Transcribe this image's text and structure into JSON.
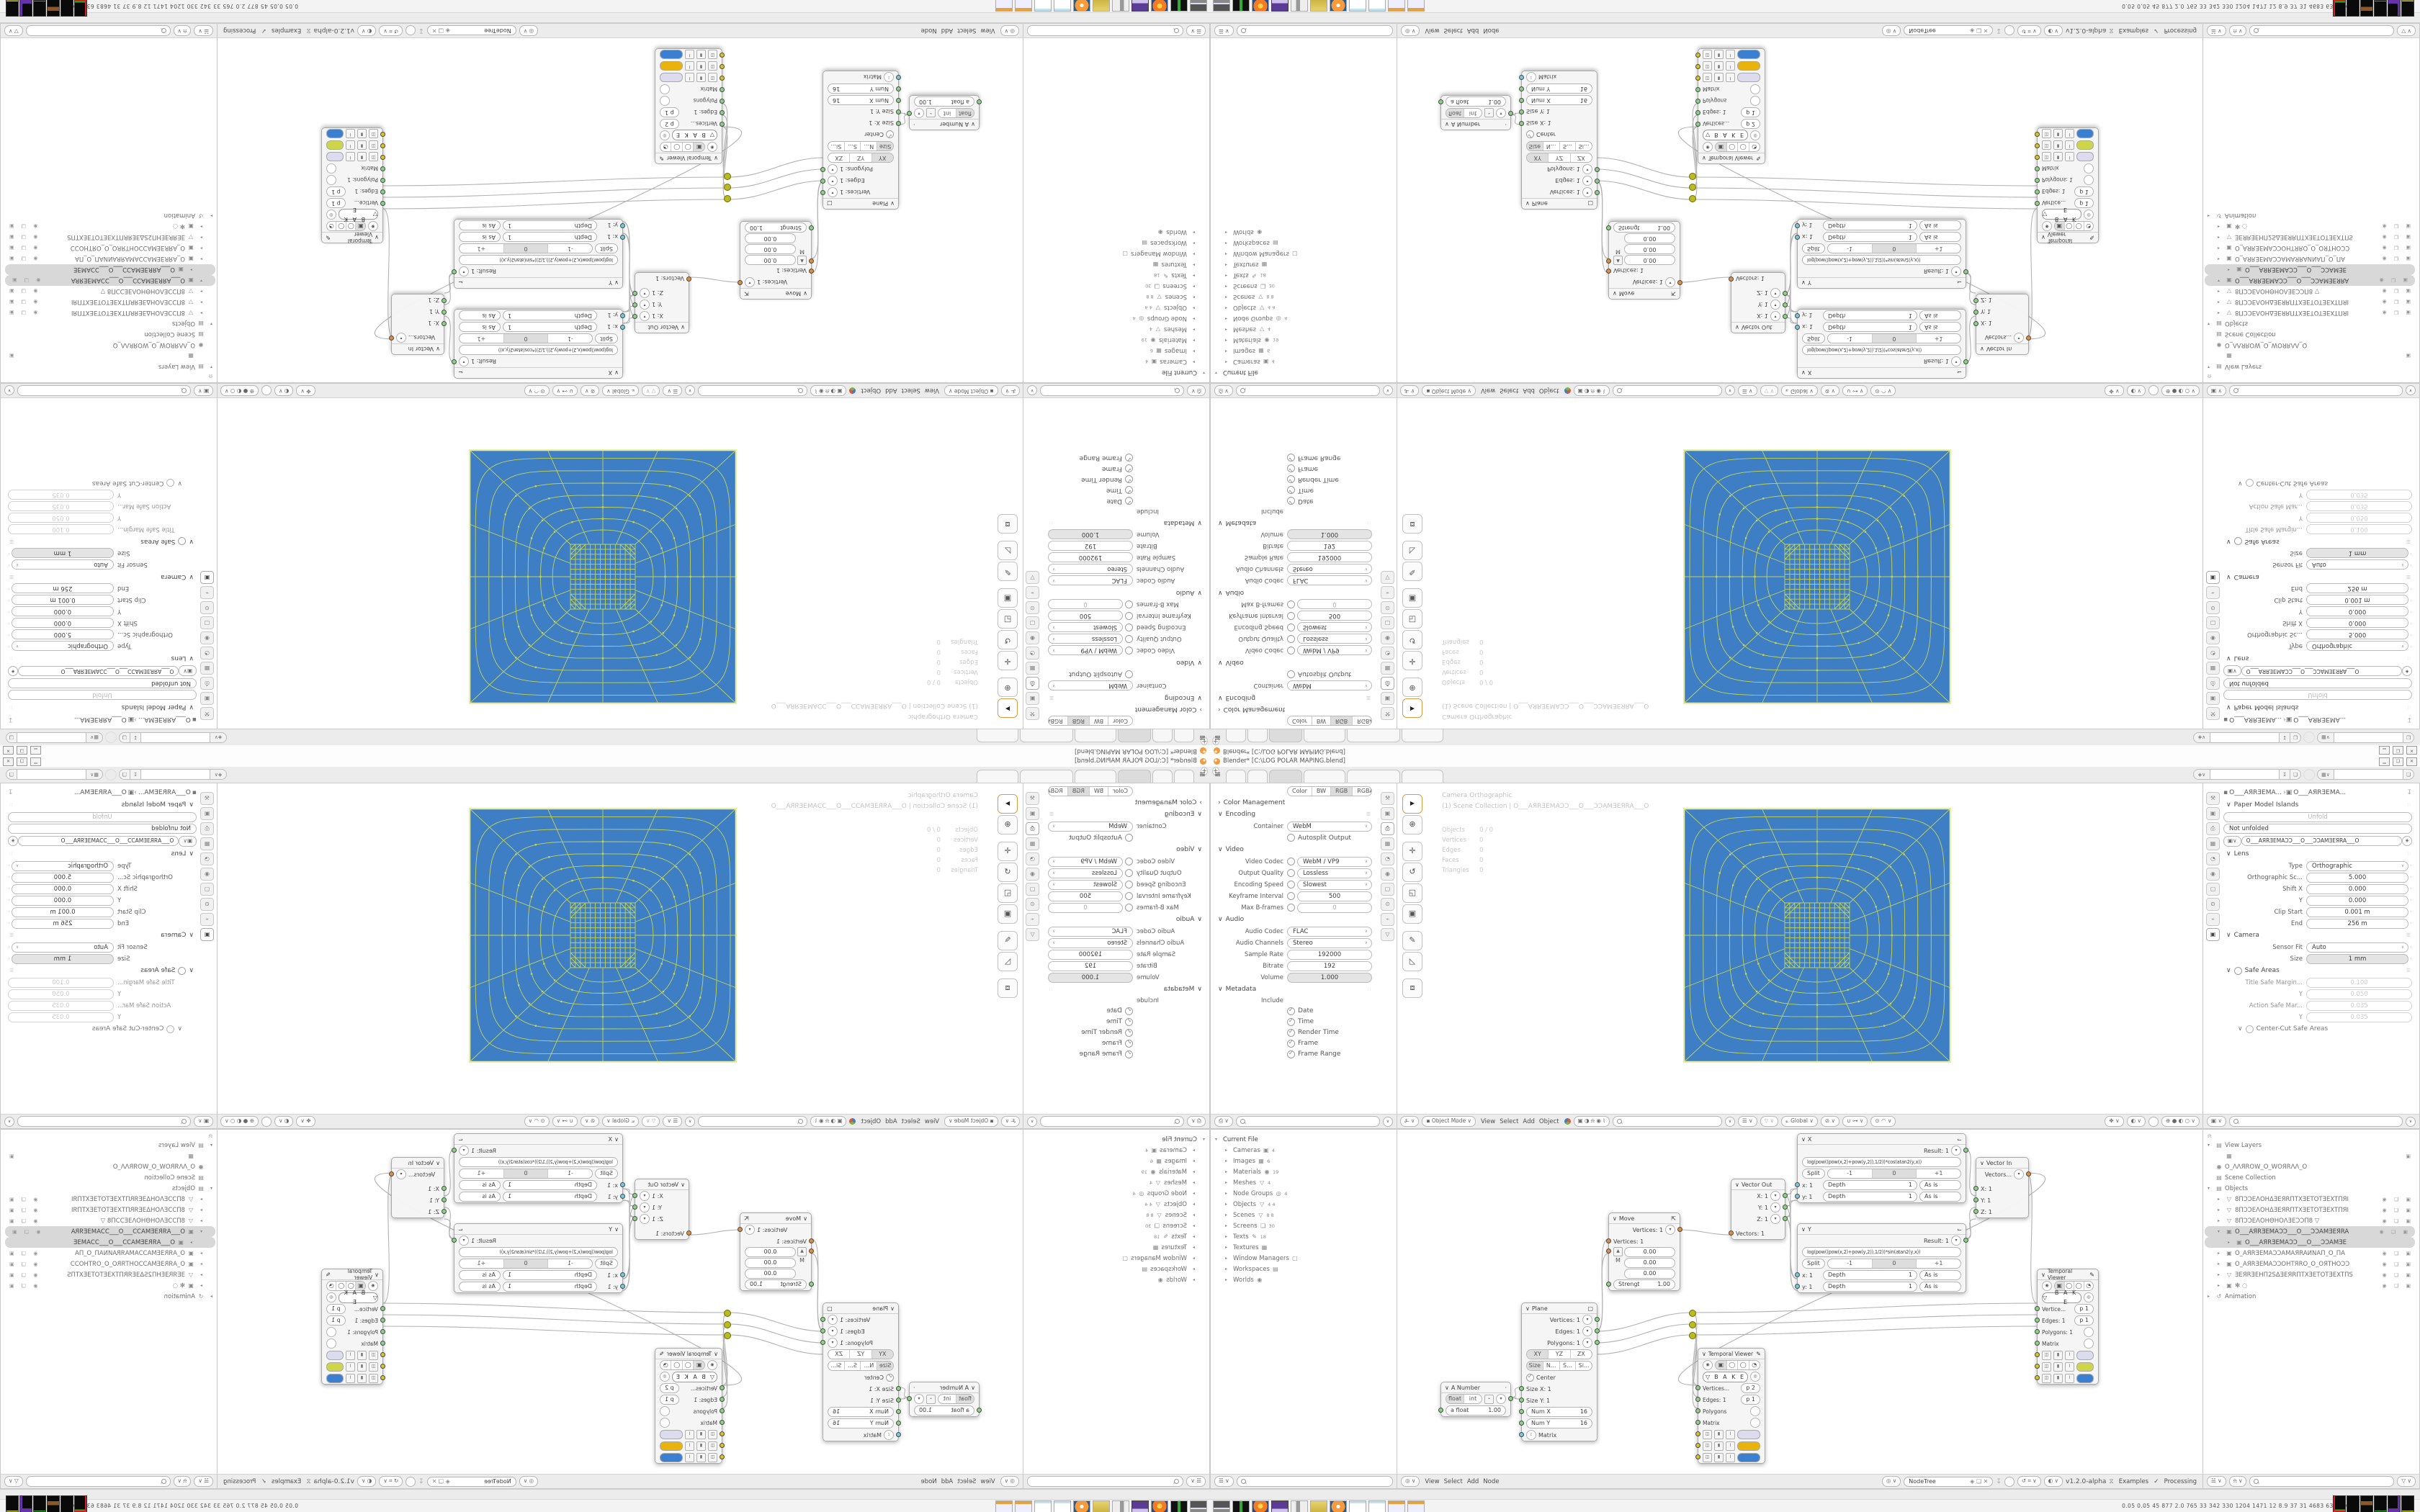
{
  "window": {
    "title": "Blender* [C:\\LOG POLAR MAPING.blend]",
    "minimize": "▁",
    "maximize": "❏",
    "close": "✕"
  },
  "icons": {
    "menu": "≡",
    "plus": "+",
    "collapse": "∨",
    "expand": "›",
    "tri_down": "▾",
    "tri_right": "▸",
    "dropdown": "∨",
    "check": "✓",
    "pin": "↧",
    "copy": "❏",
    "close_x": "✕",
    "shield": "◈",
    "dots": "∷",
    "preset": "☰",
    "flag": "⌙",
    "pencil": "✎",
    "eye": "◉",
    "bake_tri": "▽",
    "select_arrow": "▶",
    "cursor": "⊕",
    "move": "✛",
    "rotate": "↺",
    "scale": "◱",
    "transform": "▣",
    "annotate": "✎",
    "measure": "◺",
    "addcube": "⧈",
    "camera": "▣",
    "sphere_wire": "⊕",
    "sphere_solid": "●",
    "sphere_mat": "◐",
    "sphere_rend": "○",
    "magnet": "∪",
    "prop_edit": "◎",
    "gizmo": "⊙",
    "overlay": "◐",
    "up_arrow": "▲",
    "matrix": "᎒"
  },
  "tabbar": {
    "tab_widths": [
      26,
      26,
      44,
      56,
      72,
      56
    ]
  },
  "taskbar": {
    "numbers": "0.05 0.05  45  877  2.0  765  33  342  330  1204 1471  12  8.9  37  31  4683 6354",
    "chevron": "«",
    "icons": [
      {
        "name": "monitor",
        "cls": "tbi i-monitor"
      },
      {
        "name": "device",
        "cls": "tbi i-device"
      },
      {
        "name": "firefox",
        "cls": "tbi i-firefox"
      },
      {
        "name": "floppy-64",
        "cls": "tbi i-floppy"
      },
      {
        "name": "speaker",
        "cls": "tbi i-speaker"
      },
      {
        "name": "folder",
        "cls": "tbi i-folder"
      },
      {
        "name": "blender",
        "cls": "tbi i-blender"
      },
      {
        "name": "notepad",
        "cls": "tbi i-notepad"
      },
      {
        "name": "notepad",
        "cls": "tbi i-notepad"
      },
      {
        "name": "calculator",
        "cls": "tbi i-calc"
      },
      {
        "name": "calculator",
        "cls": "tbi i-calc"
      }
    ],
    "blocks": [
      {
        "cls": "blk b1"
      },
      {
        "cls": "blk b2"
      },
      {
        "cls": "blk b3"
      },
      {
        "cls": "blk b4"
      },
      {
        "cls": "blk b5"
      },
      {
        "cls": "blk b6"
      }
    ]
  },
  "output_props": {
    "color_modes": [
      {
        "label": "Color",
        "cls": ""
      },
      {
        "label": "BW",
        "cls": ""
      },
      {
        "label": "RGB",
        "cls": "on"
      },
      {
        "label": "RGBA",
        "cls": ""
      }
    ],
    "color_management": "Color Management",
    "encoding": "Encoding",
    "container_label": "Container",
    "container": "WebM",
    "autosplit": "Autosplit Output",
    "video": "Video",
    "video_rows": [
      {
        "label": "Video Codec",
        "value": "WebM / VP9",
        "vcls": "pv sel",
        "ck": "0"
      },
      {
        "label": "Output Quality",
        "value": "Lossless",
        "vcls": "pv sel",
        "ck": "0"
      },
      {
        "label": "Encoding Speed",
        "value": "Slowest",
        "vcls": "pv sel",
        "ck": "0"
      },
      {
        "label": "Keyframe Interval",
        "value": "500",
        "vcls": "pv",
        "ck": "0"
      },
      {
        "label": "Max B-frames",
        "value": "0",
        "vcls": "pv dis",
        "ck": "1"
      }
    ],
    "audio": "Audio",
    "audio_rows": [
      {
        "label": "Audio Codec",
        "value": "FLAC",
        "vcls": "pv sel",
        "ck": "0"
      },
      {
        "label": "Audio Channels",
        "value": "Stereo",
        "vcls": "pv sel",
        "ck": "0"
      },
      {
        "label": "Sample Rate",
        "value": "192000",
        "vcls": "pv",
        "ck": "0"
      },
      {
        "label": "Bitrate",
        "value": "192",
        "vcls": "pv",
        "ck": "0"
      },
      {
        "label": "Volume",
        "value": "1.000",
        "vcls": "pv slider",
        "ck": "0"
      }
    ],
    "metadata": "Metadata",
    "include_label": "Include",
    "metadata_items": [
      "Date",
      "Time",
      "Render Time",
      "Frame",
      "Frame Range"
    ]
  },
  "file_outliner": {
    "root": "Current File",
    "items": [
      {
        "label": "Cameras",
        "ic": "▣",
        "count": "4"
      },
      {
        "label": "Images",
        "ic": "▦",
        "count": "6"
      },
      {
        "label": "Materials",
        "ic": "◉",
        "count": "19"
      },
      {
        "label": "Meshes",
        "ic": "▽",
        "count": "4"
      },
      {
        "label": "Node Groups",
        "ic": "◎",
        "count": "4"
      },
      {
        "label": "Objects",
        "ic": "▽",
        "count": "4 4"
      },
      {
        "label": "Scenes",
        "ic": "▽",
        "count": "8 8"
      },
      {
        "label": "Screens",
        "ic": "❏",
        "count": "30"
      },
      {
        "label": "Texts",
        "ic": "✎",
        "count": "18"
      },
      {
        "label": "Textures",
        "ic": "▦",
        "count": ""
      },
      {
        "label": "Window Managers",
        "ic": "▢",
        "count": ""
      },
      {
        "label": "Workspaces",
        "ic": "▤",
        "count": ""
      },
      {
        "label": "Worlds",
        "ic": "◉",
        "count": ""
      }
    ]
  },
  "viewport": {
    "overlay_title": "Camera Orthographic",
    "overlay_breadcrumb": "(1) Scene Collection | O___AЯRƎEMAƆƆ___O___ƆƆAMƎEЯRA___O",
    "stats": [
      {
        "k": "Objects",
        "v": "0 / 0"
      },
      {
        "k": "Vertices",
        "v": "0"
      },
      {
        "k": "Edges",
        "v": "0"
      },
      {
        "k": "Faces",
        "v": "0"
      },
      {
        "k": "Triangles",
        "v": "0"
      }
    ],
    "mode": "Object Mode",
    "menus": [
      "View",
      "Select",
      "Add",
      "Object"
    ],
    "orientation": "Global"
  },
  "camera_props": {
    "breadcrumb_a": "O___AЯRƎEMA...",
    "breadcrumb_b": "O___AЯRƎEMA...",
    "paper_title": "Paper Model Islands",
    "unfold": "Unfold",
    "unfold_status": "Not unfolded",
    "id_name": "O___AЯRƎEMAƆƆ___O___ƆƆAMƎEЯRA___O",
    "lens": "Lens",
    "lens_rows": [
      {
        "label": "Type",
        "value": "Orthographic",
        "vcls": "pv sel"
      },
      {
        "label": "Orthographic Sc...",
        "value": "5.000",
        "vcls": "pv"
      },
      {
        "label": "Shift X",
        "value": "0.000",
        "vcls": "pv"
      },
      {
        "label": "Y",
        "value": "0.000",
        "vcls": "pv"
      },
      {
        "label": "Clip Start",
        "value": "0.001 m",
        "vcls": "pv"
      },
      {
        "label": "End",
        "value": "256 m",
        "vcls": "pv"
      }
    ],
    "camera": "Camera",
    "camera_rows": [
      {
        "label": "Sensor Fit",
        "value": "Auto",
        "vcls": "pv sel"
      },
      {
        "label": "Size",
        "value": "1 mm",
        "vcls": "pv slider"
      }
    ],
    "safe": "Safe Areas",
    "safe_rows": [
      {
        "label": "Title Safe Margin...",
        "value": "0.100",
        "vcls": "pv dis"
      },
      {
        "label": "Y",
        "value": "0.050",
        "vcls": "pv dis"
      },
      {
        "label": "Action Safe Mar...",
        "value": "0.035",
        "vcls": "pv dis"
      },
      {
        "label": "Y",
        "value": "0.035",
        "vcls": "pv dis"
      }
    ],
    "centercut": "Center-Cut Safe Areas"
  },
  "node_editor": {
    "menus": [
      "View",
      "Select",
      "Add",
      "Node"
    ],
    "tree": "NodeTree",
    "version": "v1.2.0-alpha",
    "examples": "Examples",
    "processing": "Processing",
    "x_node": {
      "title": "X",
      "result": "Result: 1",
      "formula": "log(pow((pow(x,2)+pow(y,2)),1/2))*cos(atan2(y,x))",
      "split": "Split",
      "seg": [
        {
          "label": "-1",
          "cls": ""
        },
        {
          "label": "0",
          "cls": "on"
        },
        {
          "label": "+1",
          "cls": ""
        }
      ],
      "rows": [
        {
          "s": "x: 1",
          "d": "Depth",
          "n": "1",
          "m": "As is"
        },
        {
          "s": "y: 1",
          "d": "Depth",
          "n": "1",
          "m": "As is"
        }
      ]
    },
    "y_node": {
      "title": "Y",
      "result": "Result: 1",
      "formula": "log(pow((pow(x,2)+pow(y,2)),1/2))*sin(atan2(y,x))",
      "split": "Split",
      "seg": [
        {
          "label": "-1",
          "cls": ""
        },
        {
          "label": "0",
          "cls": "on"
        },
        {
          "label": "+1",
          "cls": ""
        }
      ],
      "rows": [
        {
          "s": "x: 1",
          "d": "Depth",
          "n": "1",
          "m": "As is"
        },
        {
          "s": "y: 1",
          "d": "Depth",
          "n": "1",
          "m": "As is"
        }
      ]
    },
    "vector_in": {
      "title": "Vector In",
      "out": "Vectors...",
      "ins": [
        "X: 1",
        "Y: 1",
        "Z: 1"
      ]
    },
    "vector_out": {
      "title": "Vector Out",
      "outs": [
        "X: 1",
        "Y: 1",
        "Z: 1"
      ],
      "in": "Vectors: 1"
    },
    "move": {
      "title": "Move",
      "out": "Vertices: 1",
      "in1": "Vertices: 1",
      "m": "M",
      "vec": [
        "0.00",
        "0.00",
        "0.00"
      ],
      "strength_label": "Strengt",
      "strength": "1.00"
    },
    "plane": {
      "title": "Plane",
      "outs": [
        "Vertices: 1",
        "Edges: 1",
        "Polygons: 1"
      ],
      "axes": [
        {
          "label": "XY",
          "cls": "on"
        },
        {
          "label": "YZ",
          "cls": ""
        },
        {
          "label": "ZX",
          "cls": ""
        }
      ],
      "size_seg": [
        {
          "label": "Size",
          "cls": "on"
        },
        {
          "label": "N...",
          "cls": ""
        },
        {
          "label": "S...",
          "cls": ""
        },
        {
          "label": "Si...",
          "cls": ""
        }
      ],
      "center": "Center",
      "ins": [
        "Size X: 1",
        "Size Y: 1"
      ],
      "nums": [
        {
          "label": "Num X",
          "value": "16"
        },
        {
          "label": "Num Y",
          "value": "16"
        }
      ],
      "matrix": "Matrix"
    },
    "a_number": {
      "title": "A Number",
      "seg": [
        {
          "label": "float",
          "cls": "on"
        },
        {
          "label": "int",
          "cls": ""
        }
      ],
      "field": "a float",
      "value": "1.00"
    },
    "viewer1": {
      "title": "Temporal Viewer",
      "bake": "B A K E",
      "rows": [
        {
          "l": "Vertice...",
          "pv": "p  1"
        },
        {
          "l": "Edges: 1",
          "pv": "p  1"
        },
        {
          "l": "Polygons: 1",
          "pv": ""
        },
        {
          "l": "Matrix",
          "pv": ""
        }
      ],
      "swatches": [
        {
          "cls": "swatch",
          "c": "#dcdcee"
        },
        {
          "cls": "swatch",
          "c": "#cdd64a"
        },
        {
          "cls": "swatch",
          "c": "#3b7fd0"
        }
      ]
    },
    "viewer2": {
      "title": "Temporal Viewer",
      "bake": "B A K E",
      "rows": [
        {
          "l": "Vertices...",
          "pv": "p  2"
        },
        {
          "l": "Edges: 1",
          "pv": "p  1"
        },
        {
          "l": "Polygons",
          "pv": ""
        },
        {
          "l": "Matrix",
          "pv": ""
        }
      ],
      "swatches": [
        {
          "cls": "swatch",
          "c": "#dcdcee"
        },
        {
          "cls": "swatch",
          "c": "#e9b30b"
        },
        {
          "cls": "swatch",
          "c": "#3b7fd0"
        }
      ]
    }
  },
  "outliner": {
    "rows": [
      {
        "cls": "orow",
        "pre": "▾",
        "ic": "▤",
        "label": "View Layers",
        "badge": ""
      },
      {
        "cls": "orow indent1",
        "pre": "",
        "ic": "▦",
        "label": "",
        "badge": "▣"
      },
      {
        "cls": "orow",
        "pre": "",
        "ic": "◉",
        "label": "O_ΛΛЯROW_O_WOЯRΛΛ_O",
        "badge": ""
      },
      {
        "cls": "orow",
        "pre": "",
        "ic": "▤",
        "label": "Scene Collection",
        "badge": ""
      },
      {
        "cls": "orow",
        "pre": "▾",
        "ic": "▤",
        "label": "Objects",
        "badge": ""
      },
      {
        "cls": "orow indent1",
        "pre": "▸",
        "ic": "▽",
        "label": "8ПƆƆEΛOHΔƎEЯRПTXƎETOTƎEXTПЯI",
        "badge": "◉ ❏ ▣"
      },
      {
        "cls": "orow indent1",
        "pre": "▸",
        "ic": "▽",
        "label": "8ПƆƆEΛOHΔƎEЯRПTXƎETOTƎEXTПЯI",
        "badge": "◉ ❏ ▣"
      },
      {
        "cls": "orow indent1",
        "pre": "▸",
        "ic": "▽",
        "label": "8ПƆƆEΛOHΘHOΛƎEƆƆП8   ▽",
        "badge": "◉ ❏ ▣"
      },
      {
        "cls": "orow indent1 sel",
        "pre": "▾",
        "ic": "▣",
        "label": "O___AЯRƎEMAƆƆ___O___ƆƆAMƎEЯRA",
        "badge": "◉ ❏ ▣"
      },
      {
        "cls": "orow indent2 sel",
        "pre": "▸",
        "ic": "▣",
        "label": "O___AЯRƎEMAƆƆ___O___ƆƆAMƎE",
        "badge": ""
      },
      {
        "cls": "orow indent1",
        "pre": "▸",
        "ic": "▣",
        "label": "O_AЯRƎEMAƆƆAMAЯRAИNAП_O_ПA",
        "badge": "◉ ❏ ▣"
      },
      {
        "cls": "orow indent1",
        "pre": "▸",
        "ic": "▣",
        "label": "O_AЯRƎEMAƆƆOHTЯRO_O_OЯTHOƆƆ",
        "badge": "◉ ❏ ▣"
      },
      {
        "cls": "orow indent1",
        "pre": "▸",
        "ic": "▽",
        "label": "ƎEЯRƎEHП2SΔƎEЯRПTXƎETOTƎEXTПS",
        "badge": "◉ ❏ ▣"
      },
      {
        "cls": "orow indent1",
        "pre": "▸",
        "ic": "▣",
        "label": "✻   ◌",
        "badge": "◉ ❏ ▣"
      },
      {
        "cls": "orow",
        "pre": "▸",
        "ic": "↺",
        "label": "Animation",
        "badge": ""
      }
    ]
  },
  "render_image": {
    "bg": "#3d7ec4",
    "line": "#ccd84f",
    "border": "#e9eda1",
    "description": "log-polar mapping wireframe: dense 13x13 center grid, 7 concentric rings, 16 spokes"
  }
}
